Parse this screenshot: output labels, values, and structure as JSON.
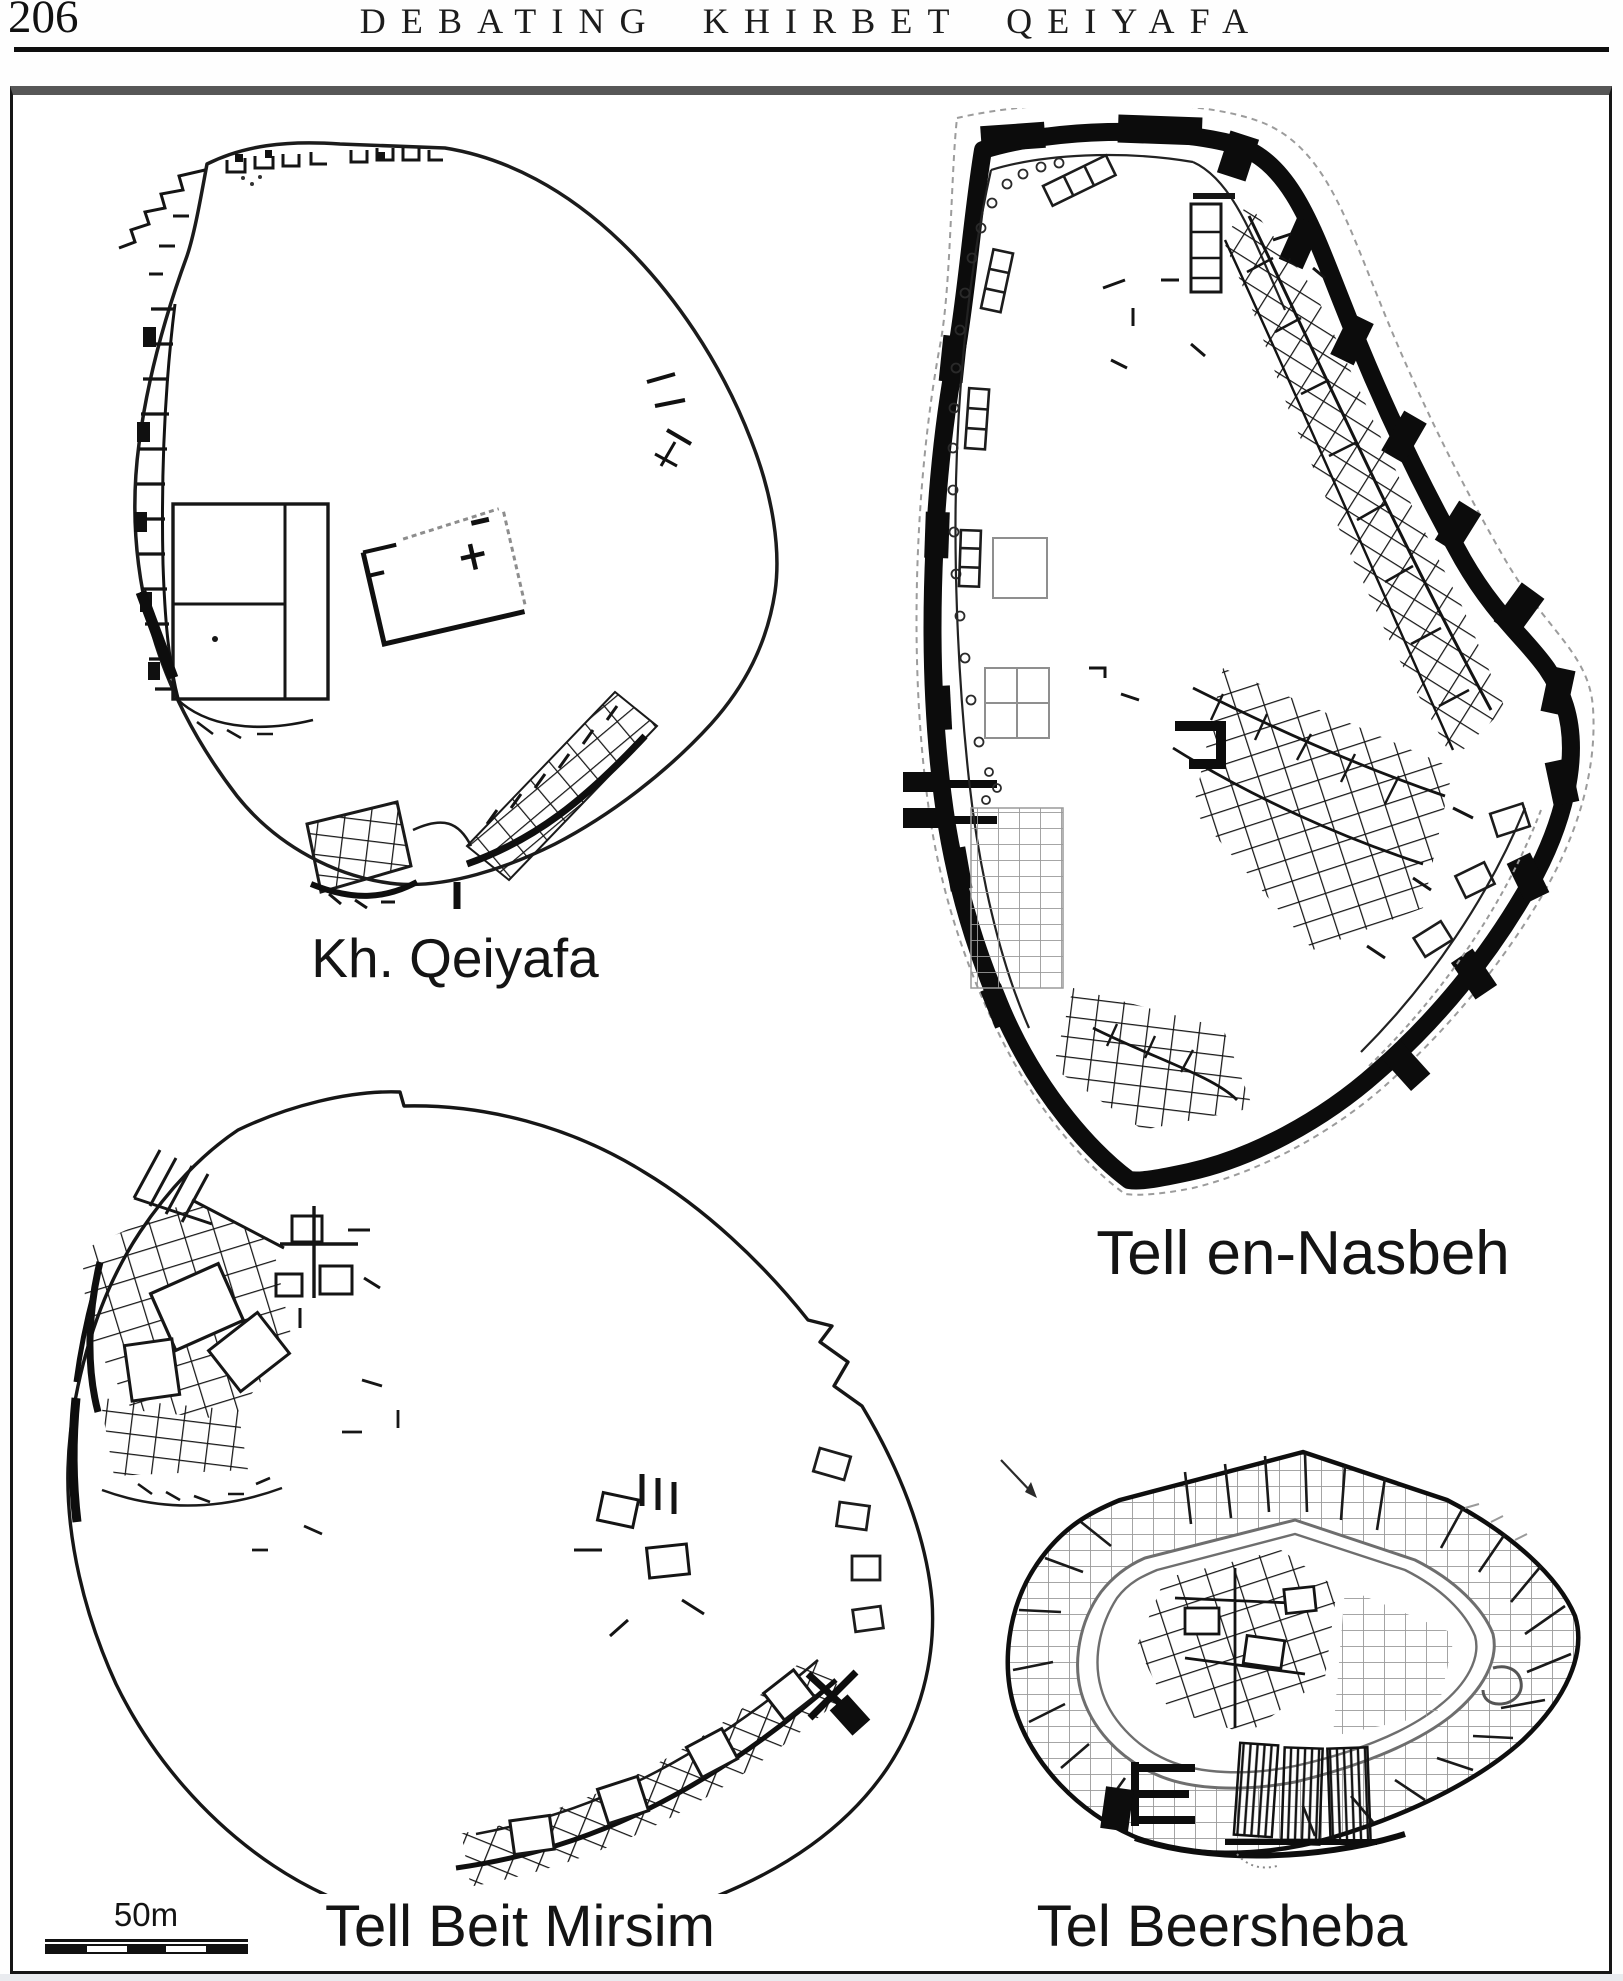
{
  "page": {
    "number": "206",
    "running_title": "DEBATING KHIRBET QEIYAFA"
  },
  "figure": {
    "description": "Comparative town plans of four Iron Age sites drawn to the same scale",
    "plans": [
      {
        "id": "qeiyafa",
        "label": "Kh. Qeiyafa"
      },
      {
        "id": "nasbeh",
        "label": "Tell en-Nasbeh"
      },
      {
        "id": "beit-mirsim",
        "label": "Tell Beit Mirsim"
      },
      {
        "id": "beersheba",
        "label": "Tel Beersheba"
      }
    ],
    "scale_bar": {
      "label": "50m"
    },
    "ink_color": "#141414",
    "faint_color": "#9a9a9a"
  }
}
